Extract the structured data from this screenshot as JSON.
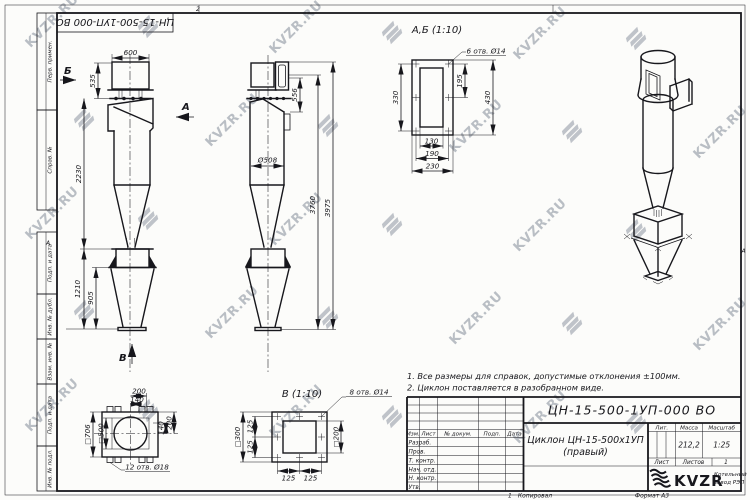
{
  "watermark": {
    "text": "KVZR.RU"
  },
  "frame": {
    "top_stamp": "ЦН-15-500-1УП-000 ВО",
    "zone_left": "А",
    "zone_right": "А",
    "fold_top": "2",
    "fold_bottom": "1",
    "copied": "Копировал",
    "format": "Формат А3",
    "sidebar": {
      "perv": "Перв. примен.",
      "sprav": "Справ. №",
      "podp1": "Подп. и дата",
      "inv_dubl": "Инв. № дубл.",
      "vzam": "Взам. инв. №",
      "podp2": "Подп. и дата",
      "inv_podl": "Инв. № подл."
    }
  },
  "notes": {
    "n1": "1. Все размеры для справок, допустимые отклонения ±100мм.",
    "n2": "2. Циклон поставляется в разобранном виде."
  },
  "front_view": {
    "dim_600": "600",
    "dim_535": "535",
    "dim_2230": "2230",
    "dim_1210": "1210",
    "dim_905": "905",
    "arrow_a": "А",
    "arrow_b": "Б",
    "arrow_v": "В"
  },
  "side_view": {
    "dim_556": "556",
    "dim_d508": "Ø508",
    "dim_3760": "3760",
    "dim_3975": "3975"
  },
  "detail_ab": {
    "title": "А,Б (1:10)",
    "holes": "6 отв. Ø14",
    "dim_330": "330",
    "dim_195": "195",
    "dim_430": "430",
    "dim_130": "130",
    "dim_190": "190",
    "dim_230": "230"
  },
  "detail_v": {
    "title": "В (1:10)",
    "holes": "8 отв. Ø14",
    "dim_s300": "□300",
    "dim_125a": "125",
    "dim_125b": "125",
    "dim_s200": "□200",
    "dim_125c": "125",
    "dim_125d": "125"
  },
  "detail_base": {
    "holes": "12 отв. Ø18",
    "dim_200t": "200",
    "dim_140t": "140",
    "dim_140r": "140",
    "dim_200r": "200",
    "dim_s706": "□706",
    "dim_s500": "□500"
  },
  "title_block": {
    "doc_number": "ЦН-15-500-1УП-000 ВО",
    "name_line1": "Циклон ЦН-15-500х1УП",
    "name_line2": "(правый)",
    "cols": {
      "izm": "Изм.",
      "list": "Лист",
      "ndokum": "№ докум.",
      "podp": "Подп.",
      "data": "Дата"
    },
    "rows": {
      "razrab": "Разраб.",
      "prov": "Пров.",
      "tkontr": "Т. контр.",
      "nachotd": "Нач. отд.",
      "nkontr": "Н. контр.",
      "utv": "Утв."
    },
    "lit": "Лит.",
    "mass": "Масса",
    "scale": "Масштаб",
    "mass_value": "212,2",
    "scale_value": "1:25",
    "sheet": "Лист",
    "sheets": "Листов",
    "sheets_value": "1",
    "brand": "KVZR",
    "brand_line1": "Котельный",
    "brand_line2": "завод РЭП"
  }
}
